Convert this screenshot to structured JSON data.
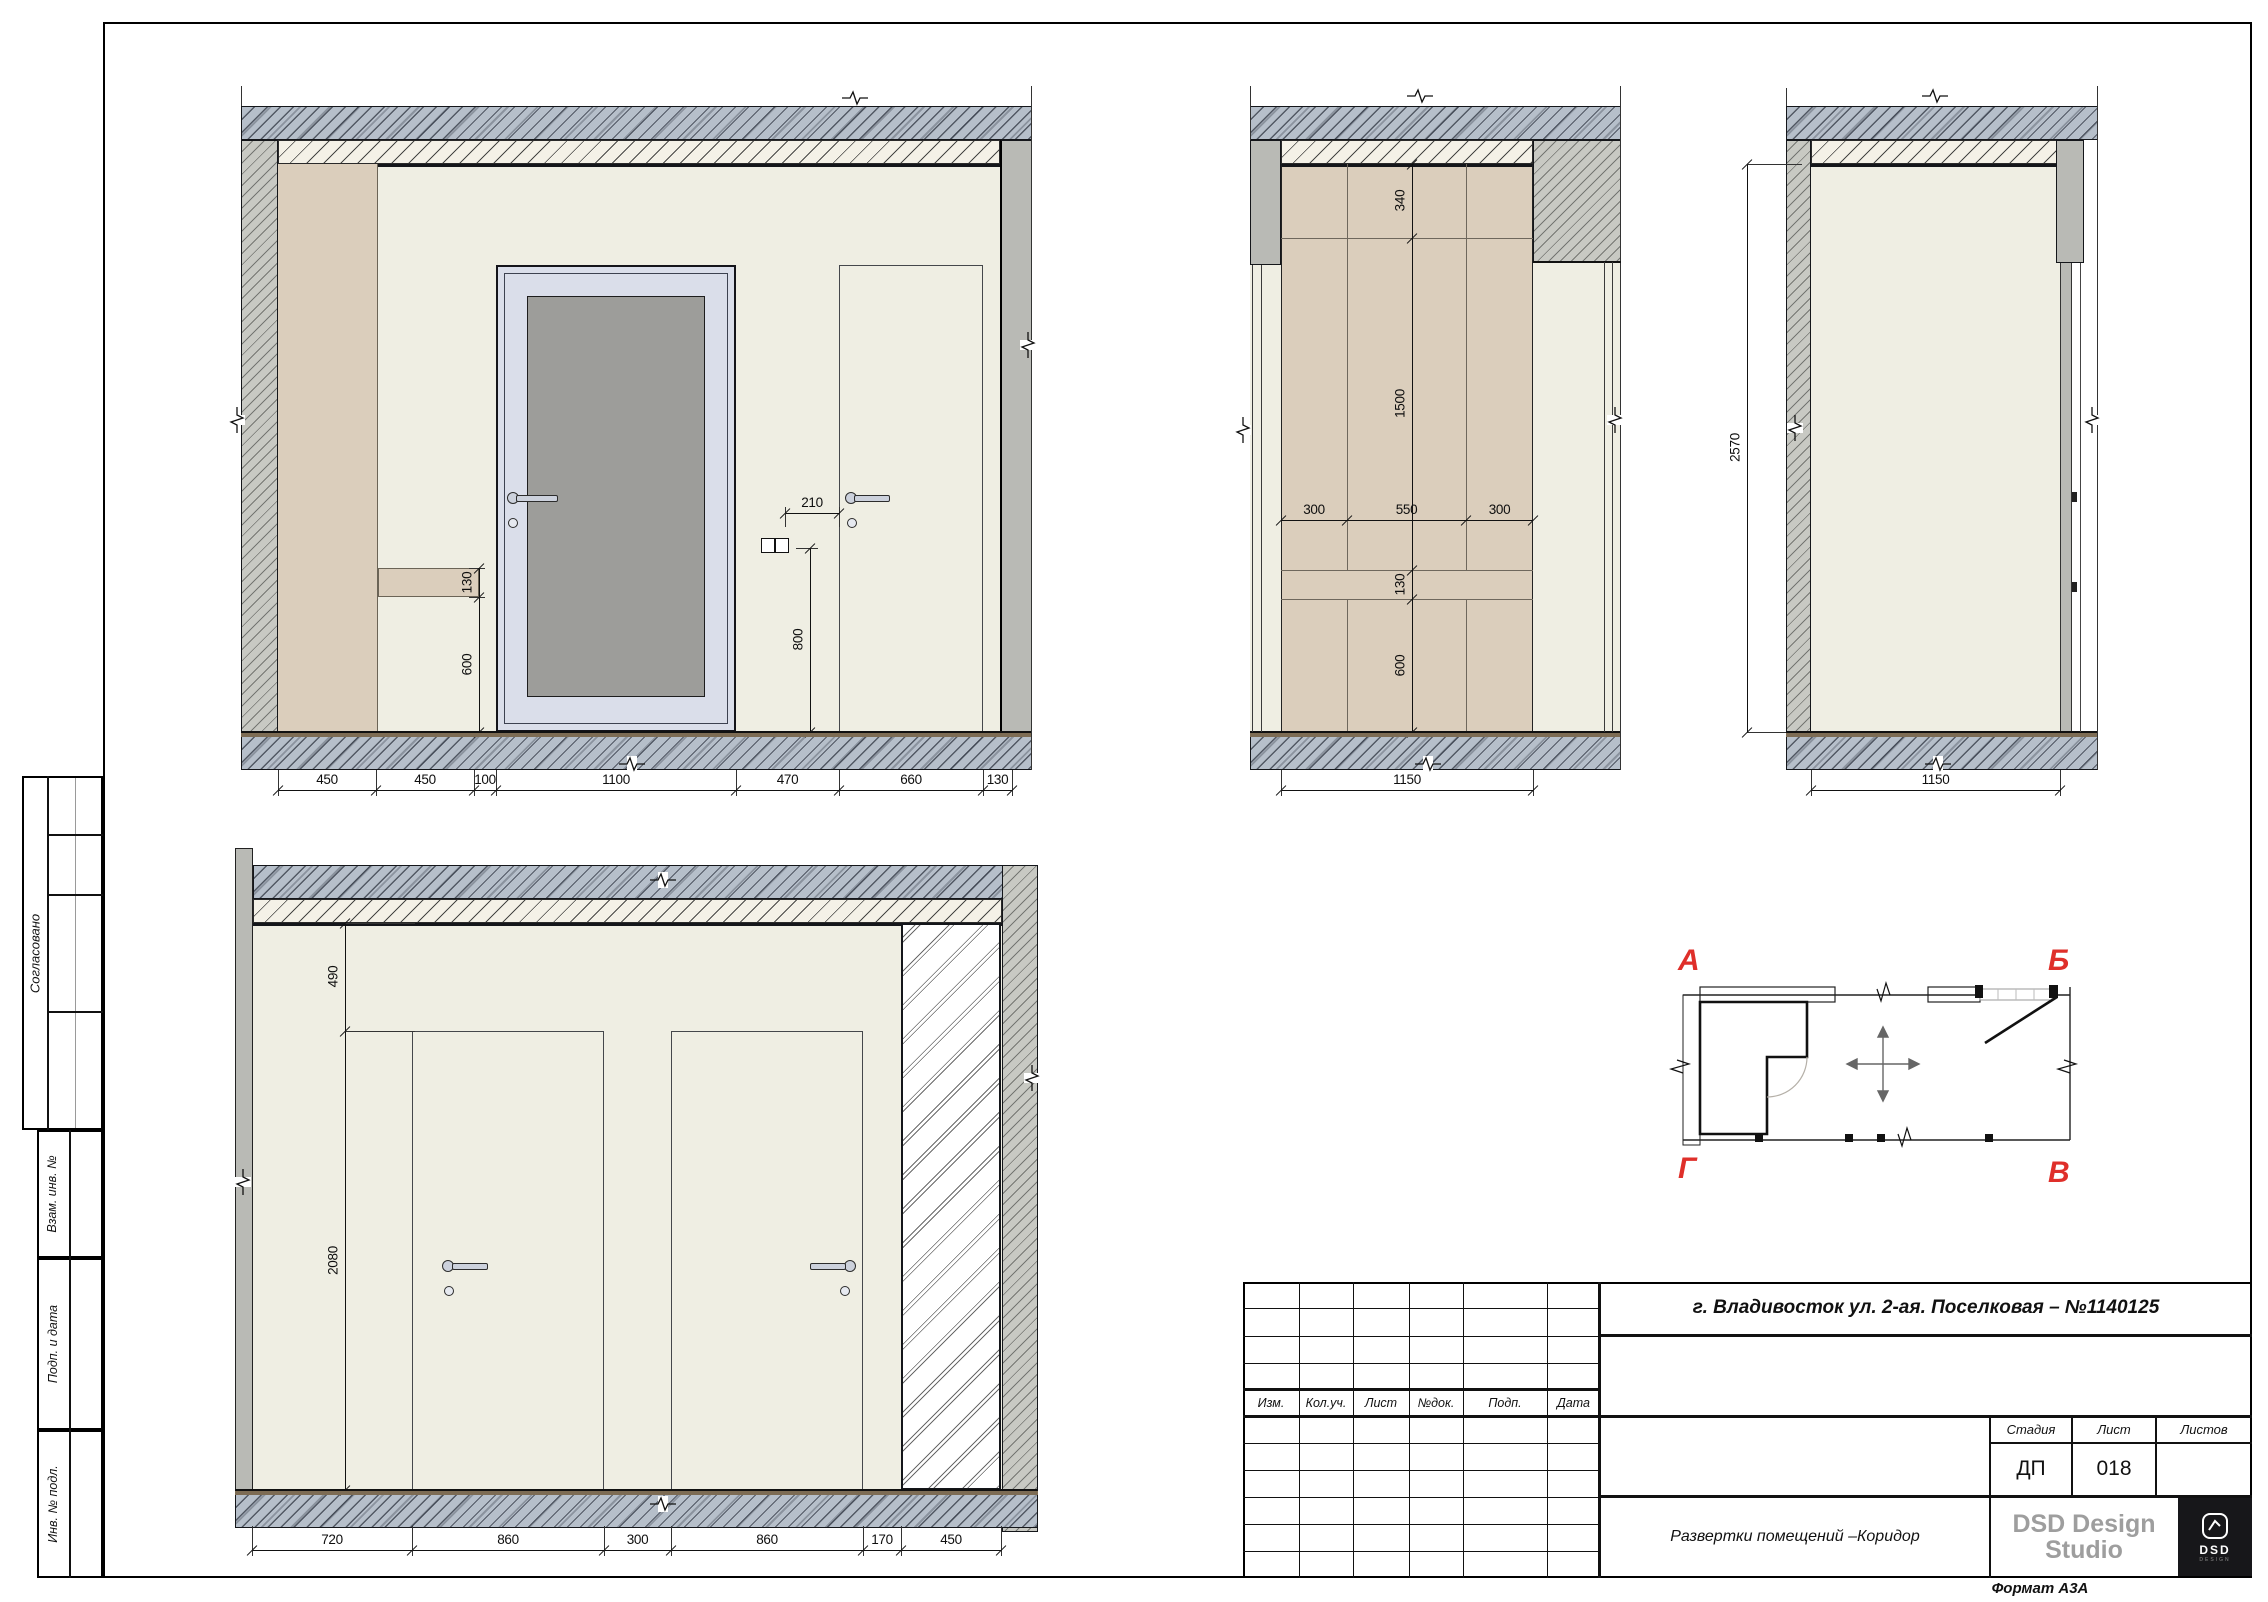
{
  "sheet": {
    "format_label": "Формат А3А"
  },
  "sidebar": {
    "approved": "Согласовано",
    "zam_inv": "Взам. инв. №",
    "podp_data": "Подп. и дата",
    "inv_podl": "Инв. № подл."
  },
  "title_block": {
    "address": "г. Владивосток ул. 2-ая. Поселковая – №1140125",
    "rev_headers": [
      "Изм.",
      "Кол.уч.",
      "Лист",
      "№док.",
      "Подп.",
      "Дата"
    ],
    "stage_label": "Стадия",
    "sheet_label": "Лист",
    "sheets_label": "Листов",
    "stage_value": "ДП",
    "sheet_value": "018",
    "sheets_value": "",
    "doc_title": "Развертки помещений –Коридор",
    "studio_line1": "DSD Design",
    "studio_line2": "Studio",
    "logo_text": "DSD",
    "logo_sub": "DESIGN"
  },
  "key_plan": {
    "corner_a": "А",
    "corner_b": "Б",
    "corner_v": "В",
    "corner_g": "Г"
  },
  "dims": {
    "e1_bottom": [
      "450",
      "450",
      "100",
      "1100",
      "470",
      "660",
      "130"
    ],
    "e1_shelf": [
      "130",
      "600"
    ],
    "e1_offset": [
      "210"
    ],
    "e1_height": [
      "800"
    ],
    "e2_vertical": [
      "340",
      "1500",
      "130",
      "600"
    ],
    "e2_columns": [
      "300",
      "550",
      "300"
    ],
    "e2_bottom": [
      "1150"
    ],
    "e3_height": [
      "2570"
    ],
    "e3_bottom": [
      "1150"
    ],
    "e4_vertical": [
      "490",
      "2080"
    ],
    "e4_bottom": [
      "720",
      "860",
      "300",
      "860",
      "170",
      "450"
    ]
  }
}
